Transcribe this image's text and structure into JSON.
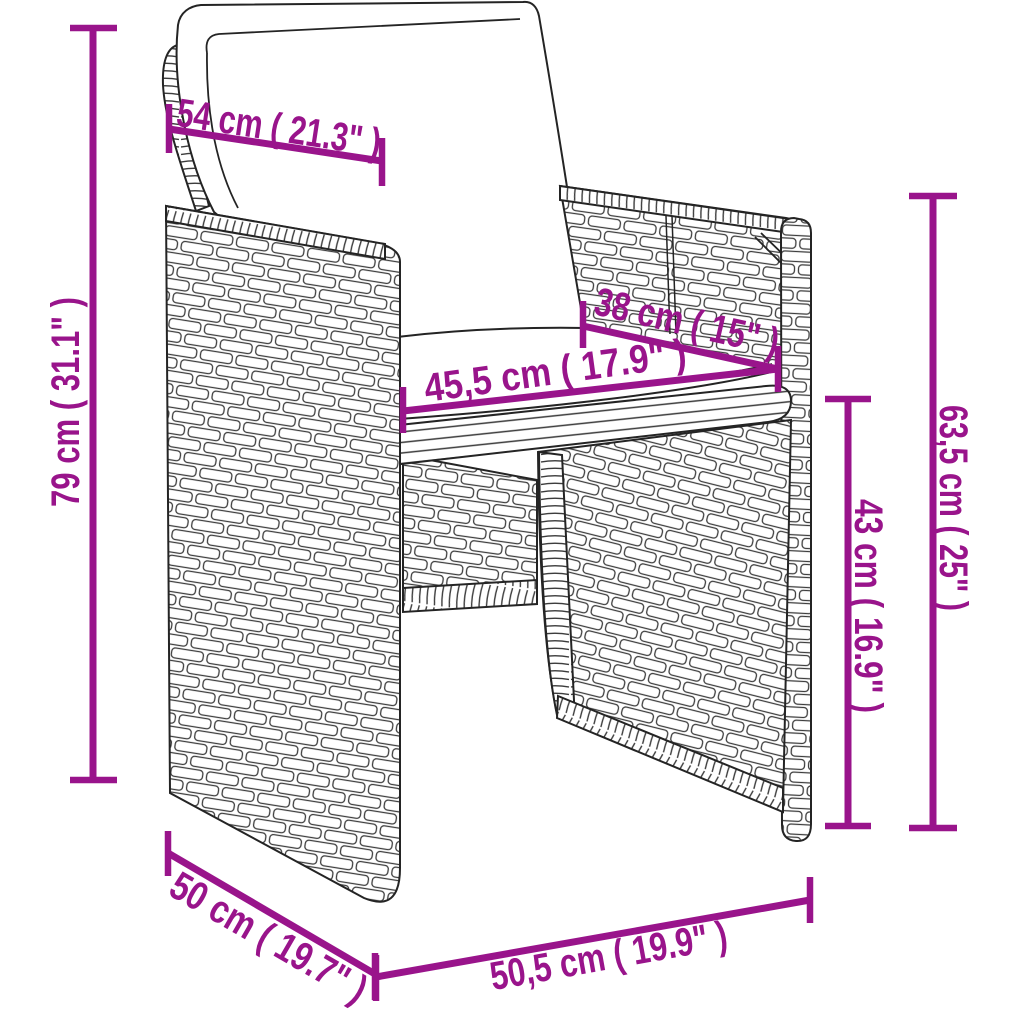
{
  "diagram": {
    "illustration": "poly-rattan-cube-chair-with-seat-and-back-cushions",
    "background": "#ffffff",
    "colors": {
      "dimension_accent": "#99148B",
      "outline": "#242424",
      "cushion_fill": "#ffffff"
    },
    "dimensions": {
      "back_cushion_width": {
        "label": "54 cm ( 21.3\" )"
      },
      "total_height": {
        "label": "79 cm ( 31.1\" )"
      },
      "seat_depth": {
        "label": "38 cm ( 15\" )"
      },
      "seat_width": {
        "label": "45,5 cm ( 17.9\" )"
      },
      "backrest_height": {
        "label": "63,5 cm ( 25\" )"
      },
      "seat_height": {
        "label": "43 cm ( 16.9\" )"
      },
      "base_depth": {
        "label": "50 cm ( 19.7\" )"
      },
      "base_width": {
        "label": "50,5 cm ( 19.9\" )"
      }
    }
  }
}
